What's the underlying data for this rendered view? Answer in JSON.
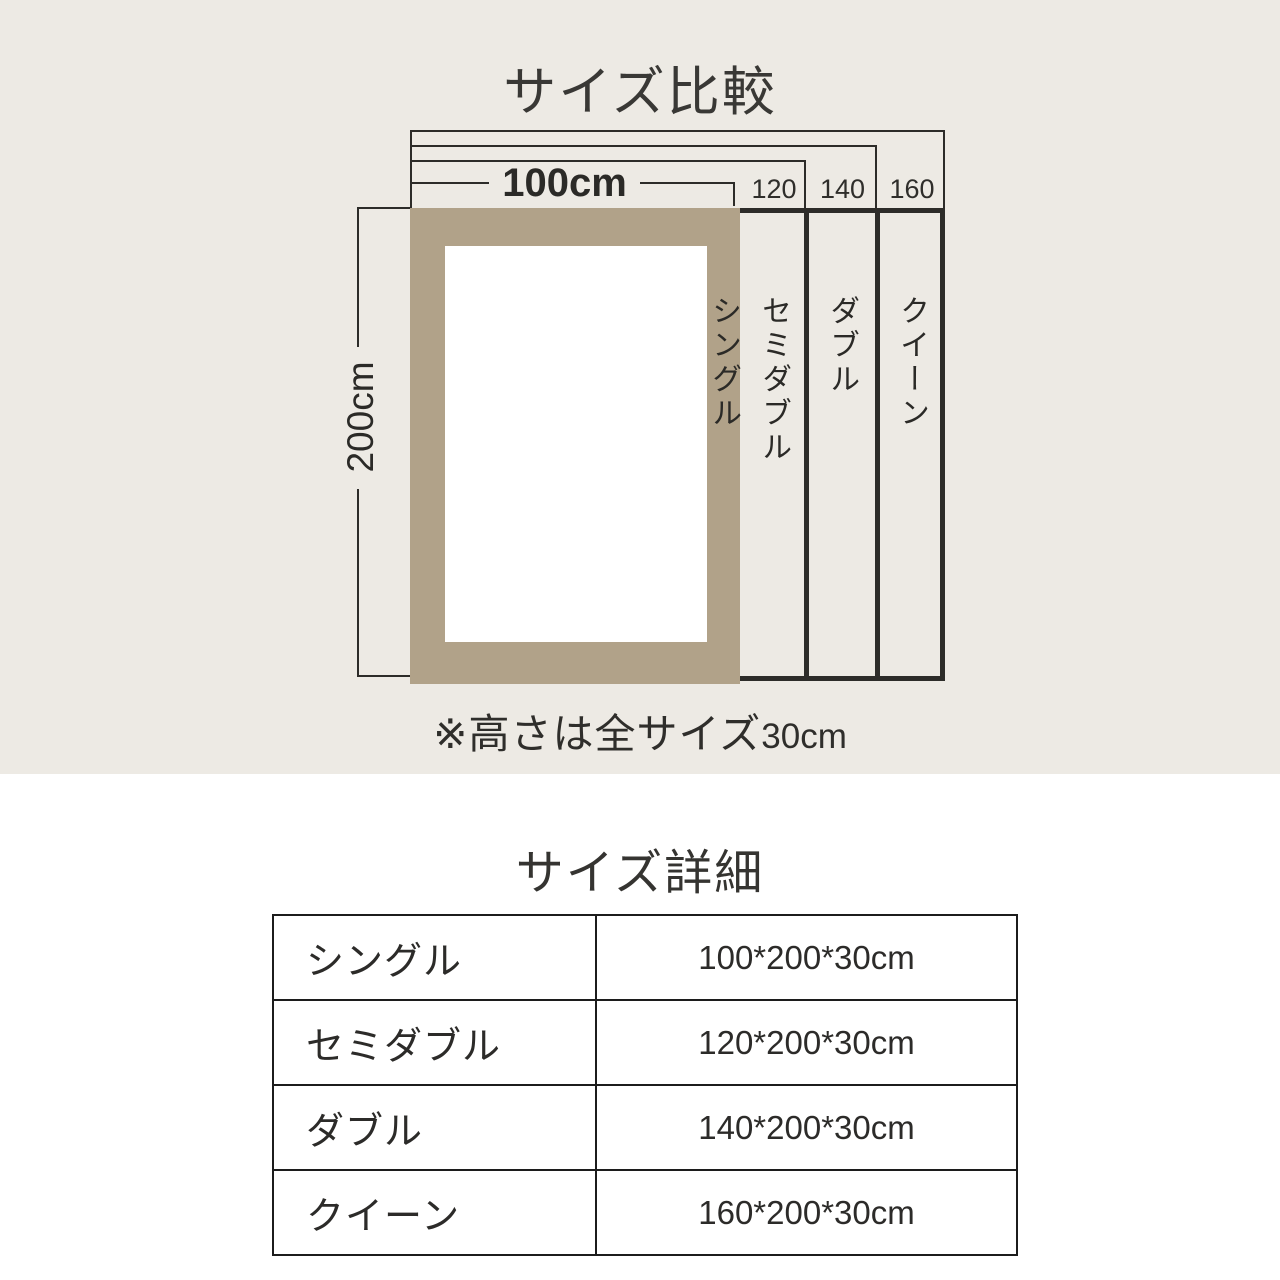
{
  "comparison": {
    "title": "サイズ比較",
    "width_label": "100cm",
    "height_label": "200cm",
    "top_labels": [
      "120",
      "140",
      "160"
    ],
    "strips": [
      {
        "label": "シングル"
      },
      {
        "label": "セミダブル"
      },
      {
        "label": "ダブル"
      },
      {
        "label": "クイーン"
      }
    ],
    "note_jp": "※高さは全サイズ",
    "note_size": "30cm"
  },
  "details": {
    "title": "サイズ詳細",
    "rows": [
      {
        "name": "シングル",
        "size": "100*200*30cm"
      },
      {
        "name": "セミダブル",
        "size": "120*200*30cm"
      },
      {
        "name": "ダブル",
        "size": "140*200*30cm"
      },
      {
        "name": "クイーン",
        "size": "160*200*30cm"
      }
    ]
  },
  "colors": {
    "background_top": "#edeae4",
    "background_bottom": "#ffffff",
    "accent_beige": "#b1a289",
    "line_ink": "#2d2c29"
  }
}
